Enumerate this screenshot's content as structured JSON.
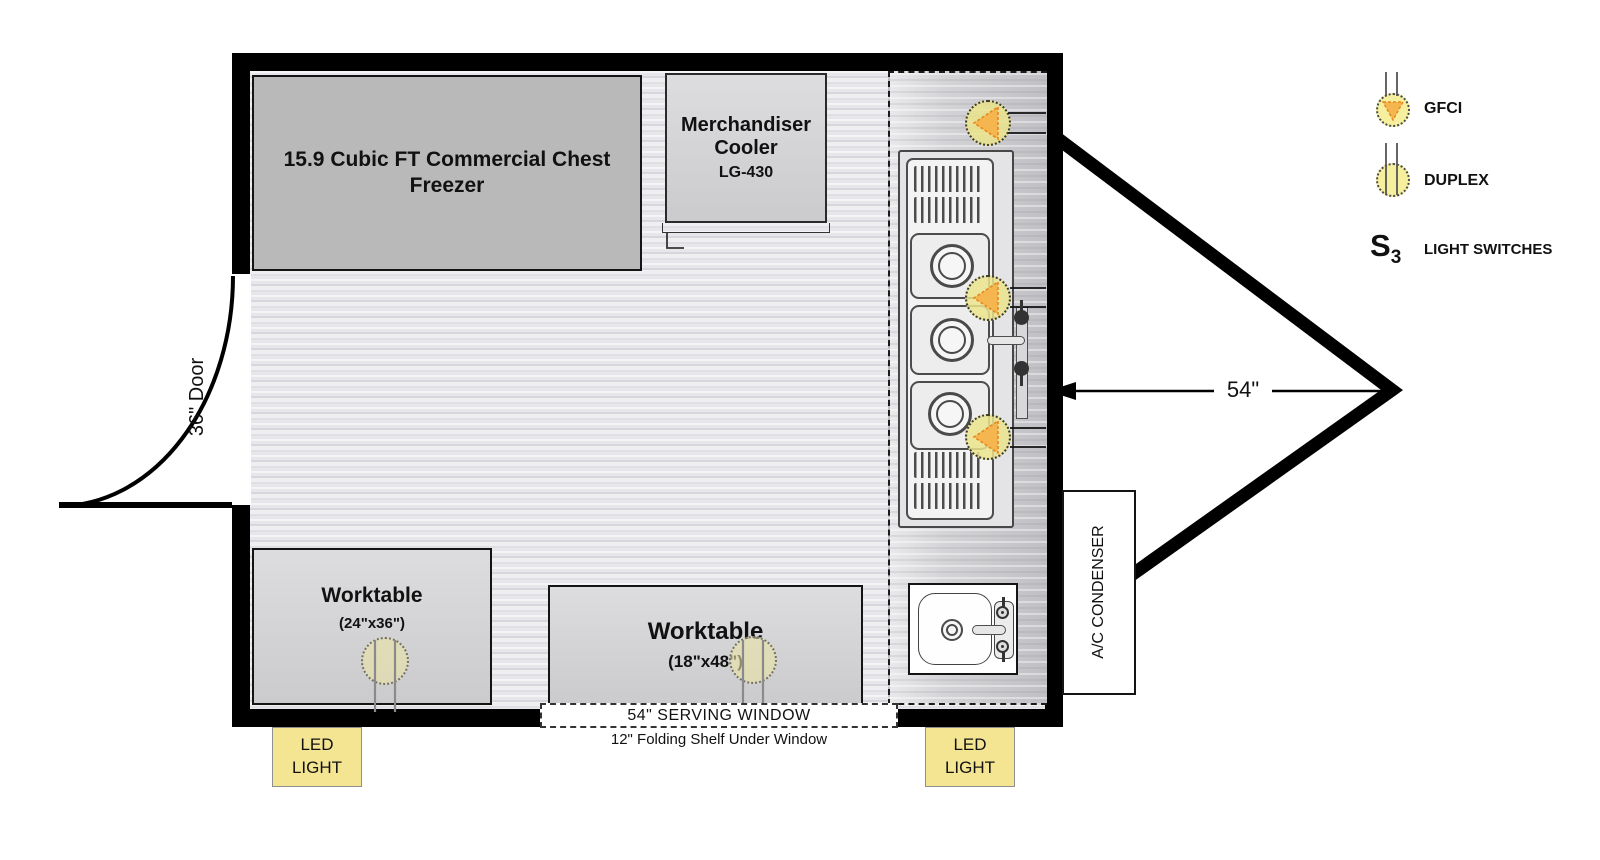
{
  "plan": {
    "freezer_label": "15.9 Cubic FT Commercial Chest Freezer",
    "cooler": {
      "line1": "Merchandiser",
      "line2": "Cooler",
      "model": "LG-430"
    },
    "door_label": "36\" Door",
    "worktable_small": {
      "name": "Worktable",
      "size": "(24\"x36\")"
    },
    "worktable_large": {
      "name": "Worktable",
      "size": "(18\"x48\")"
    },
    "serving_window_label": "54\" SERVING WINDOW",
    "folding_shelf_note": "12\" Folding Shelf Under Window",
    "led_label": {
      "line1": "LED",
      "line2": "LIGHT"
    },
    "ac_condenser_label": "A/C CONDENSER",
    "hitch_dimension": "54\""
  },
  "legend": {
    "gfci_label": "GFCI",
    "duplex_label": "DUPLEX",
    "switch_letter": "S",
    "switch_subscript": "3",
    "light_switches_label": "LIGHT SWITCHES"
  },
  "colors": {
    "wall": "#000000",
    "outlet_fill": "#ebe48c",
    "outlet_triangle": "#f5b54f",
    "led_label_bg": "#f4e593",
    "freezer_fill": "#b9b9b9"
  }
}
